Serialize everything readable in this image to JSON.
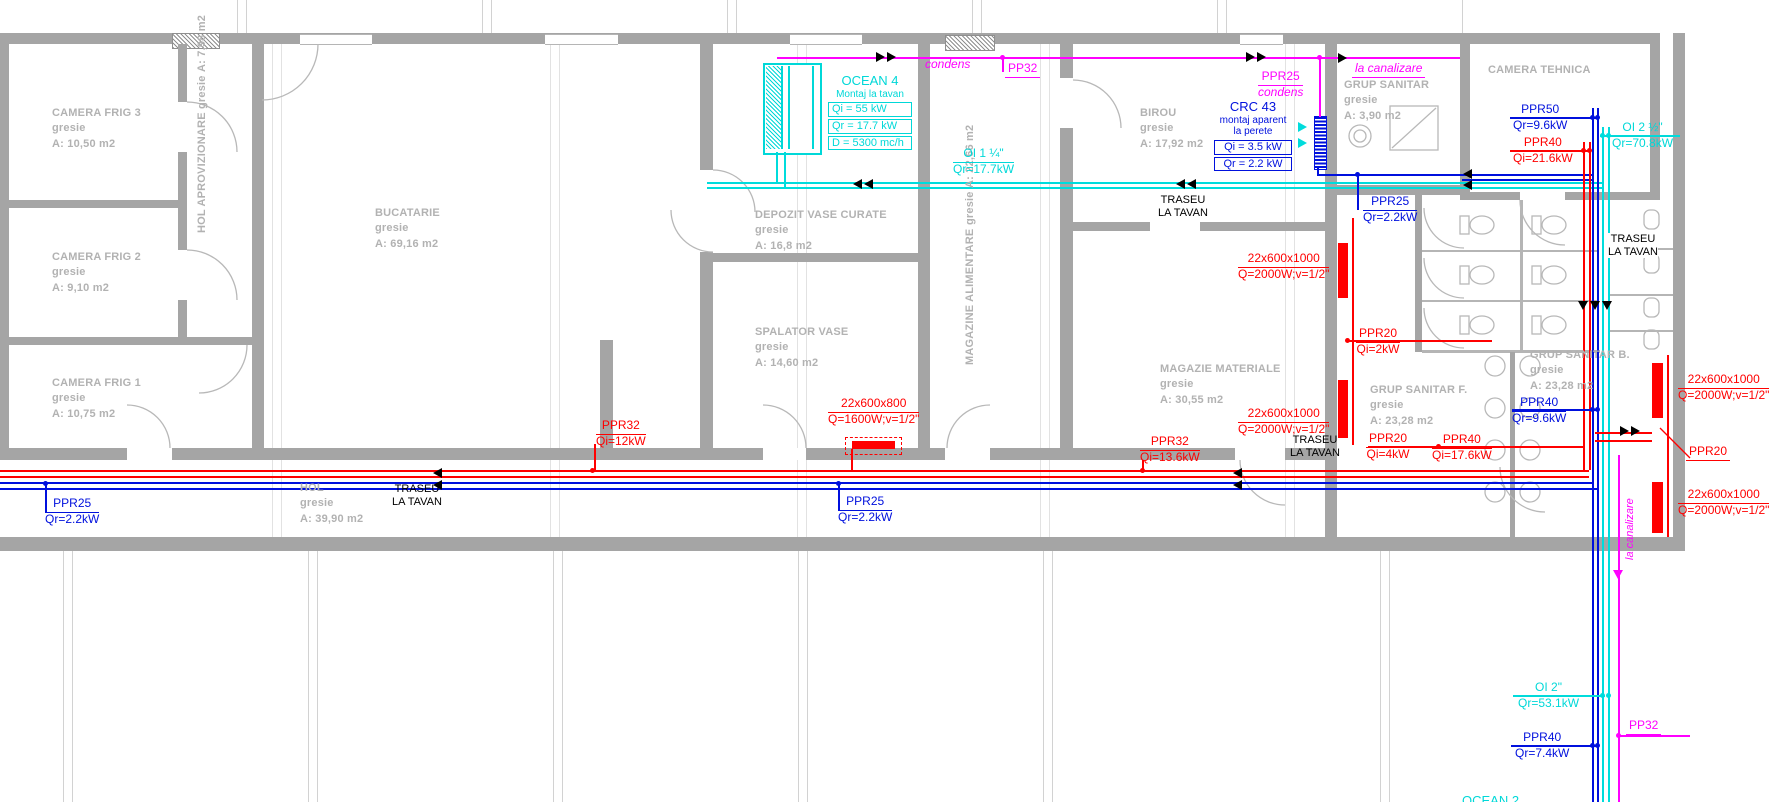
{
  "colors": {
    "wall": "#a5a5a5",
    "room_text": "#b2b2b2",
    "red": "#ff0000",
    "blue": "#0010dd",
    "cyan": "#00dcdc",
    "magenta": "#ff00ff",
    "black": "#000000"
  },
  "rooms": {
    "camera_frig_3": {
      "name": "CAMERA FRIG 3",
      "finish": "gresie",
      "area": "A: 10,50 m2"
    },
    "camera_frig_2": {
      "name": "CAMERA FRIG 2",
      "finish": "gresie",
      "area": "A: 9,10 m2"
    },
    "camera_frig_1": {
      "name": "CAMERA FRIG 1",
      "finish": "gresie",
      "area": "A: 10,75 m2"
    },
    "hol_aprovizionare": {
      "name": "HOL APROVIZIONARE",
      "finish": "gresie",
      "area": "A: 7,98 m2"
    },
    "bucatarie": {
      "name": "BUCATARIE",
      "finish": "gresie",
      "area": "A: 69,16 m2"
    },
    "depozit_vase_curate": {
      "name": "DEPOZIT VASE CURATE",
      "finish": "gresie",
      "area": "A: 16,8 m2"
    },
    "spalator_vase": {
      "name": "SPALATOR VASE",
      "finish": "gresie",
      "area": "A: 14,60 m2"
    },
    "magazine_alimentare": {
      "name": "MAGAZINE ALIMENTARE",
      "finish": "gresie",
      "area": "A: 22,66 m2"
    },
    "birou": {
      "name": "BIROU",
      "finish": "gresie",
      "area": "A: 17,92 m2"
    },
    "magazie_materiale": {
      "name": "MAGAZIE MATERIALE",
      "finish": "gresie",
      "area": "A: 30,55 m2"
    },
    "grup_sanitar": {
      "name": "GRUP SANITAR",
      "finish": "gresie",
      "area": "A: 3,90 m2"
    },
    "camera_tehnica": {
      "name": "CAMERA TEHNICA"
    },
    "grup_sanitar_f": {
      "name": "GRUP SANITAR F.",
      "finish": "gresie",
      "area": "A: 23,28 m2"
    },
    "grup_sanitar_b": {
      "name": "GRUP SANITAR B.",
      "finish": "gresie",
      "area": "A: 23,28 m2"
    },
    "hol": {
      "name": "HOL",
      "finish": "gresie",
      "area": "A: 39,90 m2"
    }
  },
  "units": {
    "ocean4": {
      "name": "OCEAN 4",
      "mount": "Montaj la tavan",
      "qi": "Qi = 55 kW",
      "qr": "Qr = 17.7 kW",
      "flow": "D = 5300 mc/h"
    },
    "crc43": {
      "name": "CRC 43",
      "mount1": "montaj aparent",
      "mount2": "la perete",
      "qi": "Qi = 3.5 kW",
      "qr": "Qr = 2.2 kW"
    },
    "ocean2": {
      "name": "OCEAN 2"
    }
  },
  "pipes": {
    "condens": "condens",
    "la_canalizare": "la canalizare",
    "pp32": "PP32",
    "ppr25_condens": {
      "name": "PPR25",
      "sub": "condens"
    },
    "oi_1_14": {
      "name": "OI 1 ¼\"",
      "val": "Qr=17.7kW"
    },
    "ppr50": {
      "name": "PPR50",
      "val": "Qr=9.6kW"
    },
    "ppr40_qi216": {
      "name": "PPR40",
      "val": "Qi=21.6kW"
    },
    "oi_2_12": {
      "name": "OI 2 ½\"",
      "val": "Qr=70.8kW"
    },
    "ppr25_qr22": {
      "name": "PPR25",
      "val": "Qr=2.2kW"
    },
    "rad_1000": {
      "name": "22x600x1000",
      "val": "Q=2000W;v=1/2\""
    },
    "rad_800": {
      "name": "22x600x800",
      "val": "Q=1600W;v=1/2\""
    },
    "ppr20_qi2": {
      "name": "PPR20",
      "val": "Qi=2kW"
    },
    "ppr20_qi4": {
      "name": "PPR20",
      "val": "Qi=4kW"
    },
    "ppr20": "PPR20",
    "ppr40_qr96": {
      "name": "PPR40",
      "val": "Qr=9.6kW"
    },
    "ppr40_qi176": {
      "name": "PPR40",
      "val": "Qi=17.6kW"
    },
    "ppr32_qi12": {
      "name": "PPR32",
      "val": "Qi=12kW"
    },
    "ppr32_qi136": {
      "name": "PPR32",
      "val": "Qi=13.6kW"
    },
    "oi_2": {
      "name": "OI 2\"",
      "val": "Qr=53.1kW"
    },
    "ppr40_qr74": {
      "name": "PPR40",
      "val": "Qr=7.4kW"
    },
    "traseu": {
      "l1": "TRASEU",
      "l2": "LA TAVAN"
    }
  }
}
